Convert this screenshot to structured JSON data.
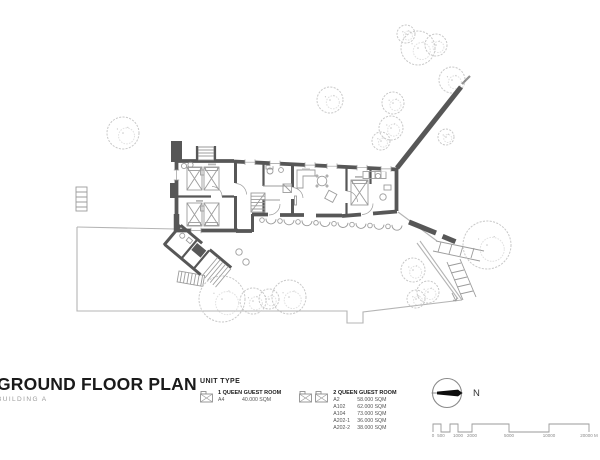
{
  "header": {
    "title": "GROUND FLOOR PLAN",
    "subtitle": "BUILDING A"
  },
  "legend": {
    "heading": "UNIT TYPE",
    "units": [
      {
        "name": "1 QUEEN GUEST ROOM",
        "icon": "queen-bed-icon",
        "rows": [
          {
            "code": "A4",
            "area": "40.000 SQM"
          }
        ]
      },
      {
        "name": "2 QUEEN GUEST ROOM",
        "icon": "queen-bed-icon",
        "rows": [
          {
            "code": "A2",
            "area": "58.000 SQM"
          },
          {
            "code": "A102",
            "area": "62.000 SQM"
          },
          {
            "code": "A104",
            "area": "73.000 SQM"
          },
          {
            "code": "A202-1",
            "area": "36.000 SQM"
          },
          {
            "code": "A202-2",
            "area": "38.000 SQM"
          }
        ]
      }
    ]
  },
  "compass": {
    "north_label": "N"
  },
  "scale_bar": {
    "labels": [
      "0",
      "500",
      "1000",
      "2000",
      "5000",
      "10000",
      "20000 M"
    ]
  },
  "colors": {
    "wall": "#575757",
    "line": "#9c9c9c",
    "tree": "#c8c8c8",
    "title": "#1a1a1a",
    "muted": "#9b9b9b"
  }
}
